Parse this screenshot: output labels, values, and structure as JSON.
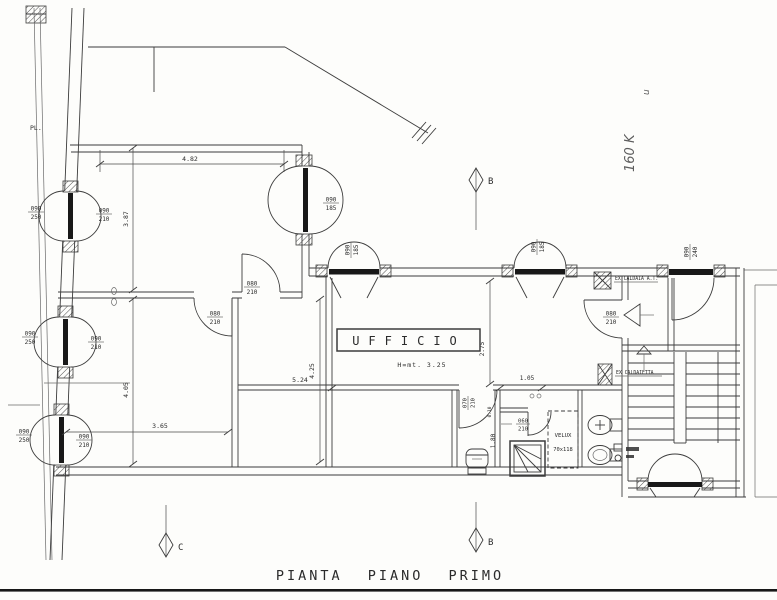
{
  "title": "PIANTA PIANO PRIMO",
  "plan": {
    "room_label": "UFFICIO",
    "height_note": "H=mt. 3.25",
    "property_line_label": "PL.",
    "velux_name": "VELUX",
    "velux_size": "70x118",
    "boiler_flag": "EX CALDAIA A.T.",
    "boiler_note": "EX CALDAIETTA",
    "handwritten_note": "160 K",
    "handwritten_mark": "u"
  },
  "sections": {
    "top": "B",
    "bottom": "B",
    "left": "C"
  },
  "dimensions": {
    "top_width": "4.82",
    "left_room_depth": "3.87",
    "lower_room_depth": "4.05",
    "lower_room_width": "3.65",
    "mid_room_depth": "4.25",
    "office_width": "5.24",
    "office_right_depth": "2.75",
    "niche_width": "1.05",
    "bath_depth": "1.80",
    "wall_thickness": "0.10"
  },
  "openings": {
    "w1_outer": {
      "w": "090",
      "h": "250"
    },
    "w1_inner": {
      "w": "090",
      "h": "210"
    },
    "w2_outer": {
      "w": "090",
      "h": "250"
    },
    "w2_inner": {
      "w": "090",
      "h": "210"
    },
    "w3_outer": {
      "w": "090",
      "h": "250"
    },
    "w3_inner": {
      "w": "090",
      "h": "210"
    },
    "door_room_a": {
      "w": "090",
      "h": "185"
    },
    "fw_center_left": {
      "w": "090",
      "h": "185"
    },
    "fw_center_right": {
      "w": "090",
      "h": "185"
    },
    "entry_door": {
      "w": "090",
      "h": "240"
    },
    "door_vestibule": {
      "w": "080",
      "h": "210"
    },
    "door_interior_up": {
      "w": "080",
      "h": "210"
    },
    "door_interior_low": {
      "w": "080",
      "h": "210"
    },
    "door_bath": {
      "w": "070",
      "h": "210"
    },
    "door_shower": {
      "w": "060",
      "h": "210"
    }
  }
}
